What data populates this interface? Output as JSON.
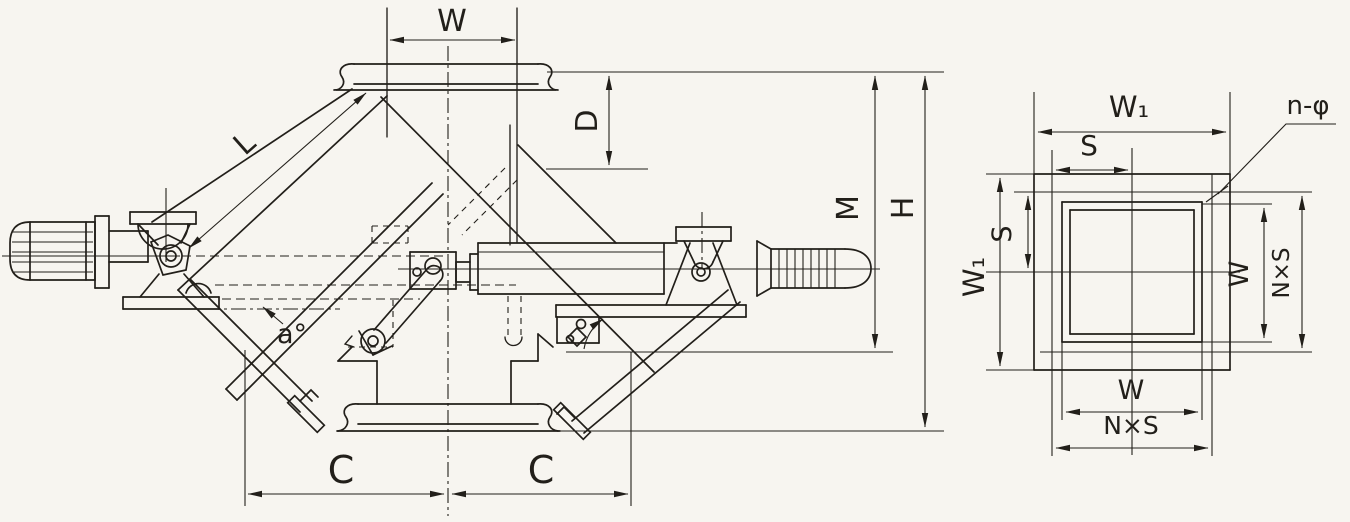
{
  "colors": {
    "background": "#f7f5f0",
    "ink": "#221f1a"
  },
  "labels": {
    "main_view": {
      "inlet_width": "W",
      "inlet_depth": "D",
      "body_length": "L",
      "height_to_frame": "M",
      "height_total": "H",
      "offset_left": "C",
      "offset_right": "C",
      "flap_angle": "a°"
    },
    "flange_view": {
      "flange_width_top": "W₁",
      "bolt_pitch_top": "S",
      "bolt_holes": "n-φ",
      "flange_width_left": "W₁",
      "bolt_pitch_left": "S",
      "opening_height_right": "W",
      "bolt_span_right": "N×S",
      "opening_width_bottom": "W",
      "bolt_span_bottom": "N×S"
    }
  }
}
